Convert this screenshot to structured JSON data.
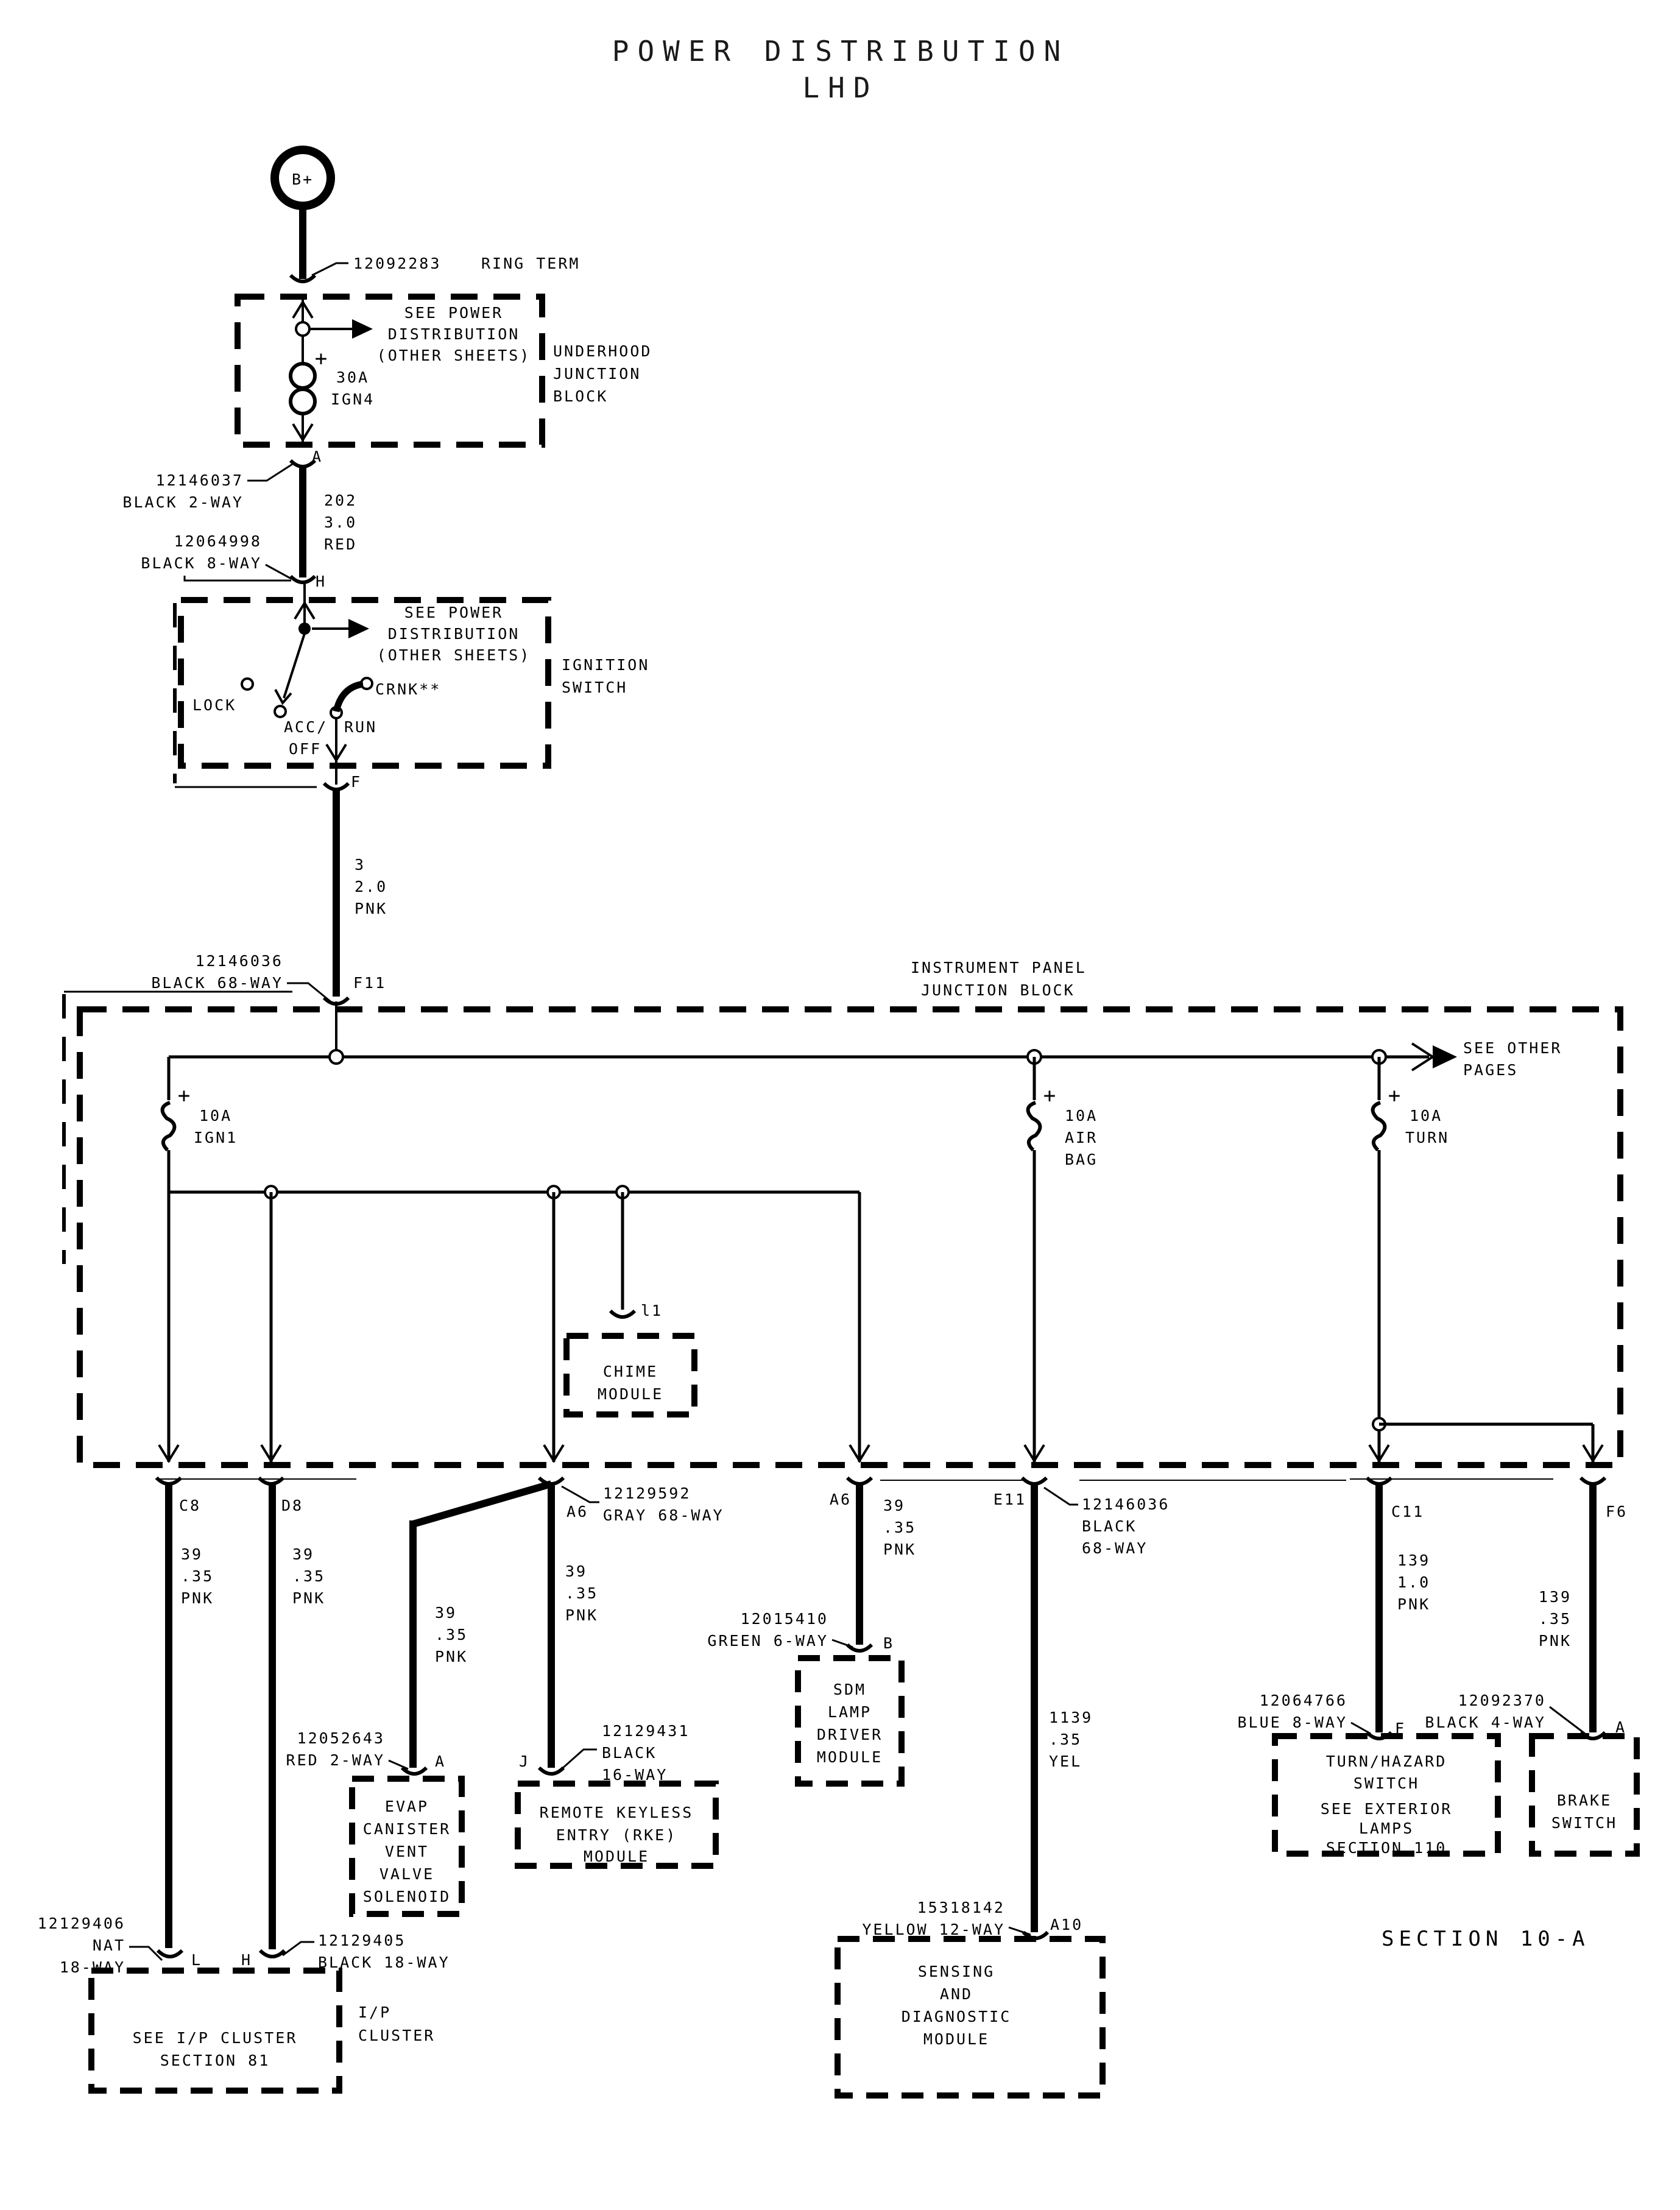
{
  "title": [
    "POWER DISTRIBUTION",
    "LHD"
  ],
  "symbols": {
    "plus": "+"
  },
  "battery": {
    "terminal": "B+"
  },
  "ring_term": {
    "part": "12092283",
    "name": "RING TERM"
  },
  "underhood_block": {
    "see_other": [
      "SEE POWER",
      "DISTRIBUTION",
      "(OTHER SHEETS)"
    ],
    "fuse": [
      "30A",
      "IGN4"
    ],
    "name": [
      "UNDERHOOD",
      "JUNCTION",
      "BLOCK"
    ],
    "pin_a": "A"
  },
  "conn_12146037": [
    "12146037",
    "BLACK 2-WAY"
  ],
  "wire_202": [
    "202",
    "3.0",
    "RED"
  ],
  "conn_12064998": [
    "12064998",
    "BLACK 8-WAY"
  ],
  "pin_h": "H",
  "ignition_switch": {
    "see_other": [
      "SEE POWER",
      "DISTRIBUTION",
      "(OTHER SHEETS)"
    ],
    "lock": "LOCK",
    "acc": "ACC/",
    "off": "OFF",
    "run": "RUN",
    "crank": "CRNK**",
    "name": [
      "IGNITION",
      "SWITCH"
    ],
    "pin_f": "F"
  },
  "wire_3": [
    "3",
    "2.0",
    "PNK"
  ],
  "conn_f11": [
    "12146036",
    "BLACK 68-WAY"
  ],
  "pin_f11": "F11",
  "ip_junction_block": {
    "name": [
      "INSTRUMENT PANEL",
      "JUNCTION BLOCK"
    ],
    "see_other": [
      "SEE OTHER",
      "PAGES"
    ],
    "fuse_ign1": [
      "10A",
      "IGN1"
    ],
    "fuse_airbag": [
      "10A",
      "AIR",
      "BAG"
    ],
    "fuse_turn": [
      "10A",
      "TURN"
    ]
  },
  "chime": {
    "pin": "l1",
    "name": [
      "CHIME",
      "MODULE"
    ]
  },
  "branch_c8": {
    "pin": "C8",
    "wire": [
      "39",
      ".35",
      "PNK"
    ]
  },
  "branch_d8": {
    "pin": "D8",
    "wire": [
      "39",
      ".35",
      "PNK"
    ]
  },
  "branch_a6_left": {
    "pin": "A6",
    "conn": [
      "12129592",
      "GRAY 68-WAY"
    ],
    "wire_evap": [
      "39",
      ".35",
      "PNK"
    ],
    "wire_rke": [
      "39",
      ".35",
      "PNK"
    ]
  },
  "evap": {
    "conn": [
      "12052643",
      "RED 2-WAY"
    ],
    "pin": "A",
    "name": [
      "EVAP",
      "CANISTER",
      "VENT",
      "VALVE",
      "SOLENOID"
    ]
  },
  "rke": {
    "pin": "J",
    "conn": [
      "12129431",
      "BLACK",
      "16-WAY"
    ],
    "name": [
      "REMOTE KEYLESS",
      "ENTRY (RKE)",
      "MODULE"
    ]
  },
  "branch_sdm_lamp": {
    "pin": "A6",
    "wire": [
      "39",
      ".35",
      "PNK"
    ],
    "conn": [
      "12015410",
      "GREEN 6-WAY"
    ],
    "pin_b": "B",
    "name": [
      "SDM",
      "LAMP",
      "DRIVER",
      "MODULE"
    ]
  },
  "branch_e11": {
    "pin": "E11",
    "conn": [
      "12146036",
      "BLACK",
      "68-WAY"
    ],
    "wire": [
      "1139",
      ".35",
      "YEL"
    ],
    "conn2": [
      "15318142",
      "YELLOW 12-WAY"
    ],
    "pin_a10": "A10",
    "name": [
      "SENSING",
      "AND",
      "DIAGNOSTIC",
      "MODULE"
    ]
  },
  "branch_c11": {
    "pin": "C11",
    "wire": [
      "139",
      "1.0",
      "PNK"
    ],
    "conn": [
      "12064766",
      "BLUE 8-WAY"
    ],
    "pin_f": "F",
    "name": [
      "TURN/HAZARD",
      "SWITCH"
    ],
    "note": [
      "SEE EXTERIOR",
      "LAMPS",
      "SECTION 110"
    ]
  },
  "branch_f6": {
    "pin": "F6",
    "wire": [
      "139",
      ".35",
      "PNK"
    ],
    "conn": [
      "12092370",
      "BLACK 4-WAY"
    ],
    "pin_a": "A",
    "name": [
      "BRAKE",
      "SWITCH"
    ]
  },
  "ip_cluster": {
    "conn_left": [
      "12129406",
      "NAT",
      "18-WAY"
    ],
    "pin_l": "L",
    "pin_h": "H",
    "conn_right": [
      "12129405",
      "BLACK 18-WAY"
    ],
    "box": [
      "SEE I/P CLUSTER",
      "SECTION 81"
    ],
    "name": [
      "I/P",
      "CLUSTER"
    ]
  },
  "section": "SECTION 10-A"
}
